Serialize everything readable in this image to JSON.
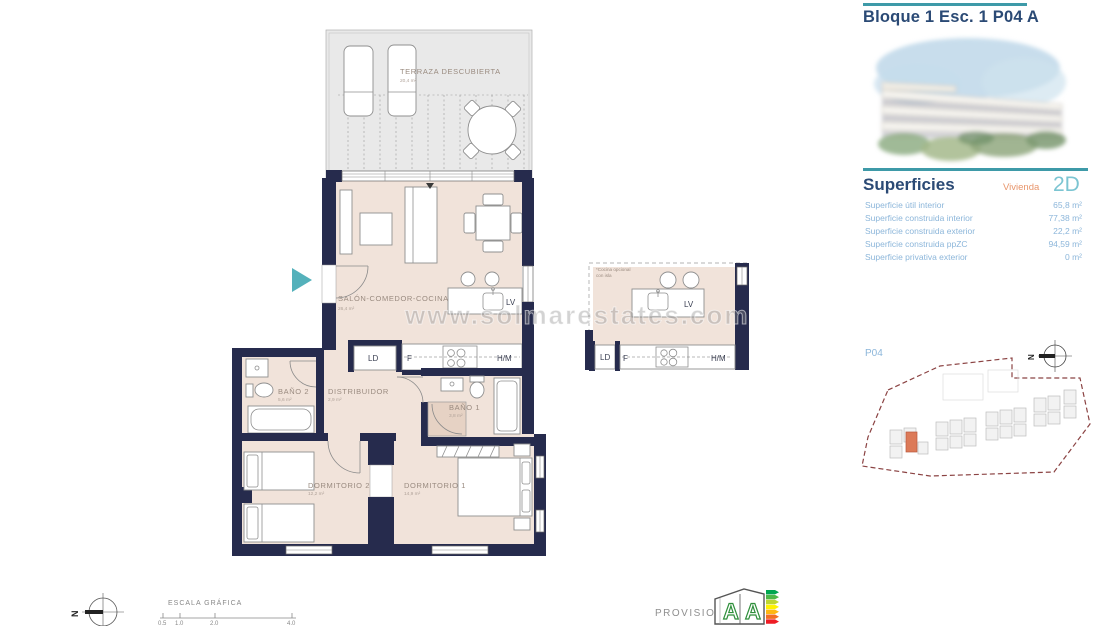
{
  "colors": {
    "wall_navy": "#262b4d",
    "floor_beige": "#f1e3da",
    "terrace_gray": "#e9e9e9",
    "accent_teal": "#3e9aa8",
    "accent_orange": "#e8956b",
    "highlight_building": "#dc7a58",
    "text_lightblue": "#8cb6da",
    "title_navy": "#2b4a75"
  },
  "header": {
    "title": "Bloque 1 Esc. 1 P04 A"
  },
  "superficies": {
    "heading": "Superficies",
    "vivienda_label": "Vivienda",
    "vivienda_type": "2D",
    "rows": [
      {
        "label": "Superficie útil interior",
        "value": "65,8 m²"
      },
      {
        "label": "Superficie construida interior",
        "value": "77,38 m²"
      },
      {
        "label": "Superficie construida exterior",
        "value": "22,2 m²"
      },
      {
        "label": "Superficie construida ppZC",
        "value": "94,59 m²"
      },
      {
        "label": "Superficie privativa exterior",
        "value": "0 m²"
      }
    ]
  },
  "plan": {
    "rooms": {
      "terraza": {
        "name": "TERRAZA DESCUBIERTA",
        "area": "20,4 m²"
      },
      "salon": {
        "name": "SALÓN-COMEDOR-COCINA",
        "area": "26,4 m²"
      },
      "bano2": {
        "name": "BAÑO 2",
        "area": "5,6 m²"
      },
      "distribuidor": {
        "name": "DISTRIBUIDOR",
        "area": "2,9 m²"
      },
      "bano1": {
        "name": "BAÑO 1",
        "area": "3,8 m²"
      },
      "dormitorio2": {
        "name": "DORMITORIO 2",
        "area": "12,2 m²"
      },
      "dormitorio1": {
        "name": "DORMITORIO 1",
        "area": "14,9 m²"
      }
    },
    "kitchen": {
      "ld": "LD",
      "f": "F",
      "hm": "H/M",
      "lv": "LV"
    },
    "optional_note": {
      "line1": "*Cocina opcional",
      "line2": "con isla"
    }
  },
  "siteplan": {
    "label": "P04"
  },
  "compass": {
    "letter": "N"
  },
  "watermark": {
    "text": "www.solmarestates.com"
  },
  "scale": {
    "label": "ESCALA GRÁFICA",
    "ticks": [
      "0.5",
      "1.0",
      "2.0",
      "4.0"
    ]
  },
  "footer": {
    "provisional": "PROVISIONAL"
  },
  "energy": {
    "letter_left": "A",
    "letter_right": "A"
  }
}
